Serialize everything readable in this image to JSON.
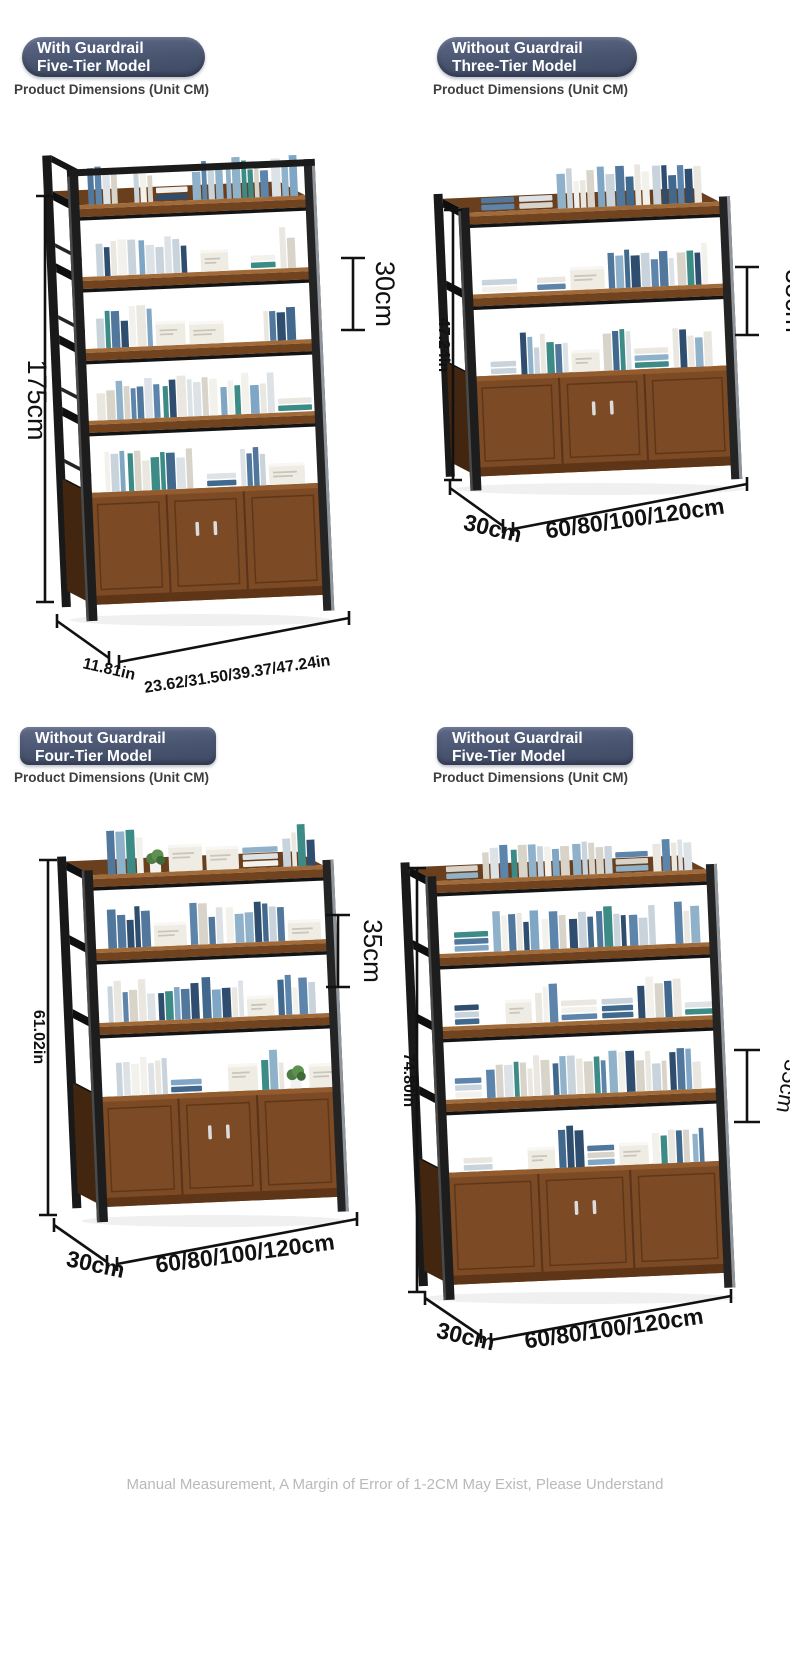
{
  "page": {
    "footer": "Manual Measurement, A Margin of Error of 1-2CM May Exist, Please Understand"
  },
  "colors": {
    "badge_gradient_top": "#5e6988",
    "badge_gradient_bottom": "#3e4965",
    "wood_light": "#a06a39",
    "wood_mid": "#7c4a24",
    "wood_dark": "#5e3517",
    "frame_black": "#1d1d1d",
    "metal_gray": "#8f959a",
    "dimension_line": "#111111",
    "footer_text": "#b9b9b9"
  },
  "quadrants": [
    {
      "badge_line1": "With Guardrail",
      "badge_line2": "Five-Tier Model",
      "subtitle": "Product Dimensions (Unit CM)",
      "tiers": 5,
      "guardrail": true,
      "dims": {
        "height": "175cm",
        "tier_gap": "30cm",
        "depth": "11.81in",
        "width": "23.62/31.50/39.37/47.24in"
      }
    },
    {
      "badge_line1": "Without Guardrail",
      "badge_line2": "Three-Tier Model",
      "subtitle": "Product Dimensions (Unit CM)",
      "tiers": 3,
      "guardrail": false,
      "dims": {
        "height": "47.24in",
        "tier_gap": "35cm",
        "depth": "30cm",
        "width": "60/80/100/120cm"
      }
    },
    {
      "badge_line1": "Without Guardrail",
      "badge_line2": "Four-Tier Model",
      "subtitle": "Product Dimensions (Unit CM)",
      "tiers": 4,
      "guardrail": false,
      "dims": {
        "height": "61.02in",
        "tier_gap": "35cm",
        "depth": "30cm",
        "width": "60/80/100/120cm"
      }
    },
    {
      "badge_line1": "Without Guardrail",
      "badge_line2": "Five-Tier Model",
      "subtitle": "Product Dimensions (Unit CM)",
      "tiers": 5,
      "guardrail": false,
      "dims": {
        "height": "74.80in",
        "tier_gap": "35cm",
        "depth": "30cm",
        "width": "60/80/100/120cm"
      }
    }
  ]
}
